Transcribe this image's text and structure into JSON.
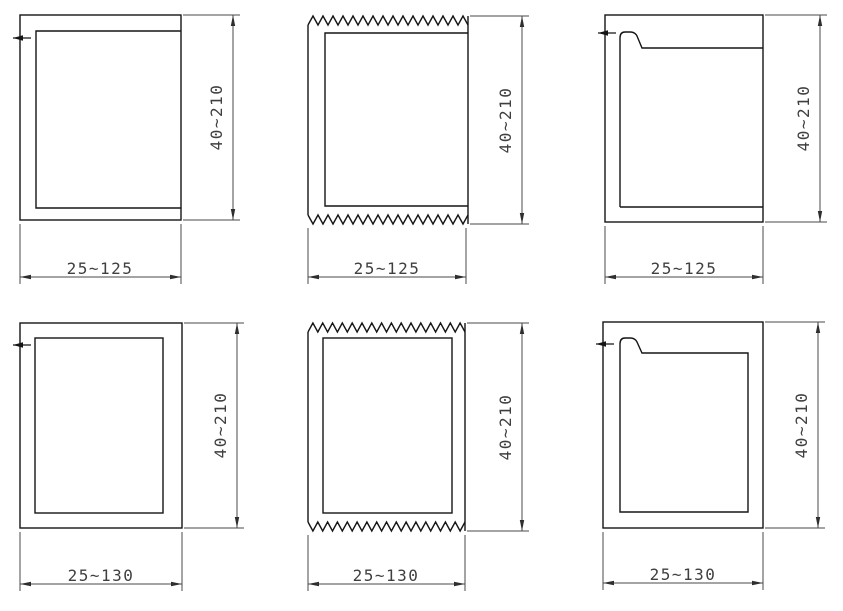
{
  "document": {
    "kind": "cad-profile-drawing-sheet",
    "background": "#ffffff",
    "rows": 2,
    "columns": 3
  },
  "colors": {
    "profile_line": "#151515",
    "dimension_line": "#4a4a4a",
    "text": "#3f3f3f"
  },
  "drawings": [
    {
      "position": "top-left",
      "profile_type": "u-channel-plain-edge",
      "height_label": "40~210",
      "width_label": "25~125"
    },
    {
      "position": "top-middle",
      "profile_type": "serrated-top-bottom-open-right",
      "height_label": "40~210",
      "width_label": "25~125"
    },
    {
      "position": "top-right",
      "profile_type": "hooked-lip-open-right",
      "height_label": "40~210",
      "width_label": "25~125"
    },
    {
      "position": "bottom-left",
      "profile_type": "closed-box",
      "height_label": "40~210",
      "width_label": "25~130"
    },
    {
      "position": "bottom-middle",
      "profile_type": "serrated-top-bottom-closed",
      "height_label": "40~210",
      "width_label": "25~130"
    },
    {
      "position": "bottom-right",
      "profile_type": "hooked-lip-closed",
      "height_label": "40~210",
      "width_label": "25~130"
    }
  ]
}
